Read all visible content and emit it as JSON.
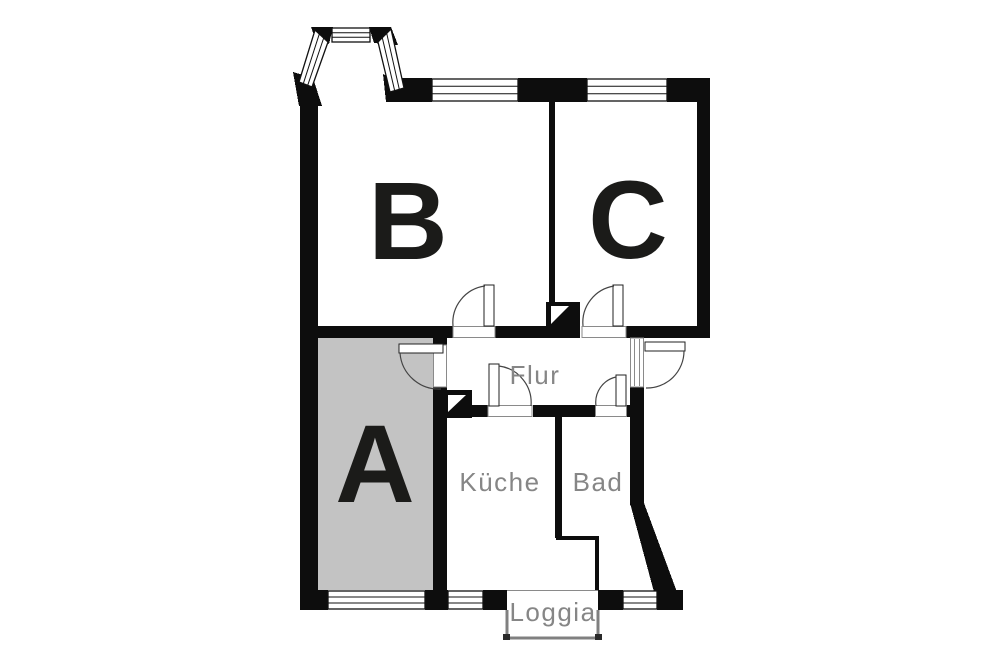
{
  "rooms": {
    "a": {
      "label": "A"
    },
    "b": {
      "label": "B"
    },
    "c": {
      "label": "C"
    },
    "flur": {
      "label": "Flur"
    },
    "kueche": {
      "label": "Küche"
    },
    "bad": {
      "label": "Bad"
    },
    "loggia": {
      "label": "Loggia"
    }
  },
  "colors": {
    "background": "#ffffff",
    "wall": "#0d0d0d",
    "room_a_fill": "#c3c3c3",
    "room_label": "#1b1b19",
    "small_label": "#868686",
    "door_line": "#444444",
    "leaf_line": "#222222",
    "threshold_line": "#8a8a8a",
    "window_line": "#111111",
    "loggia_wall": "#808080"
  }
}
